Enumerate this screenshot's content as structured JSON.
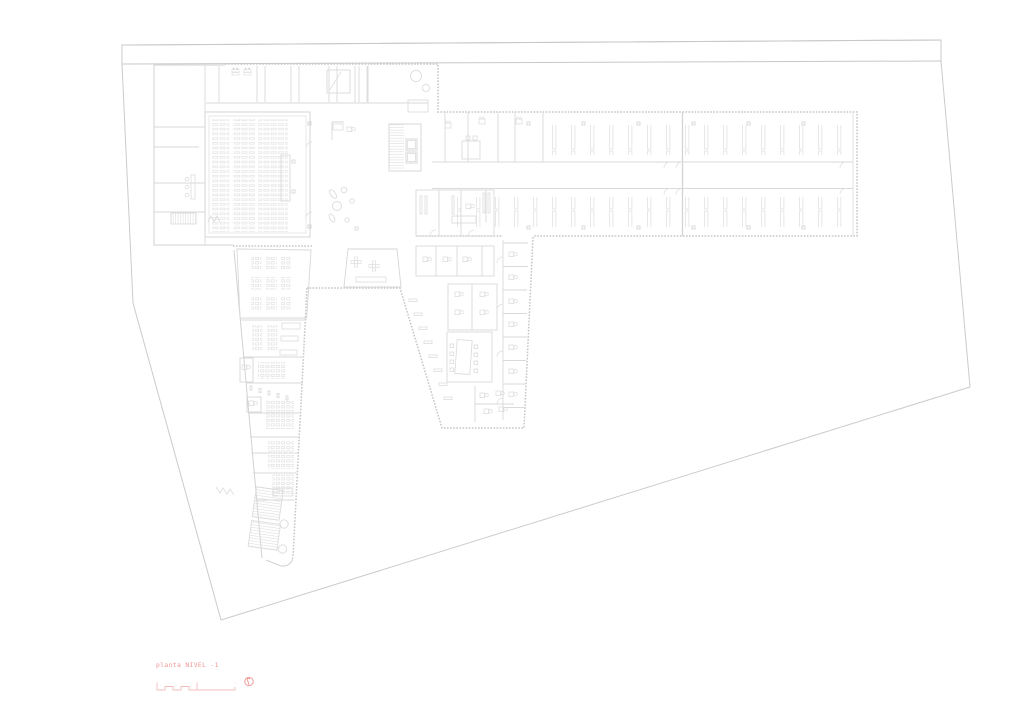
{
  "drawing": {
    "title_label": "planta NIVEL -1",
    "scale_end_mark": "″",
    "level": "-1"
  },
  "icons": {
    "north_arrow": "north-arrow-icon",
    "scale_bar": "graphic-scale-bar"
  },
  "colors": {
    "background": "#ffffff",
    "site_line": "#cccccc",
    "road_band": "#c8c8c8",
    "building_line": "#d2d2d2",
    "interior_line": "#dadada",
    "furniture_line": "#e0e0e0",
    "hatch_band": "#c5c5c5",
    "accent_red": "#f09494",
    "accent_red_light": "#f6bcbc"
  }
}
